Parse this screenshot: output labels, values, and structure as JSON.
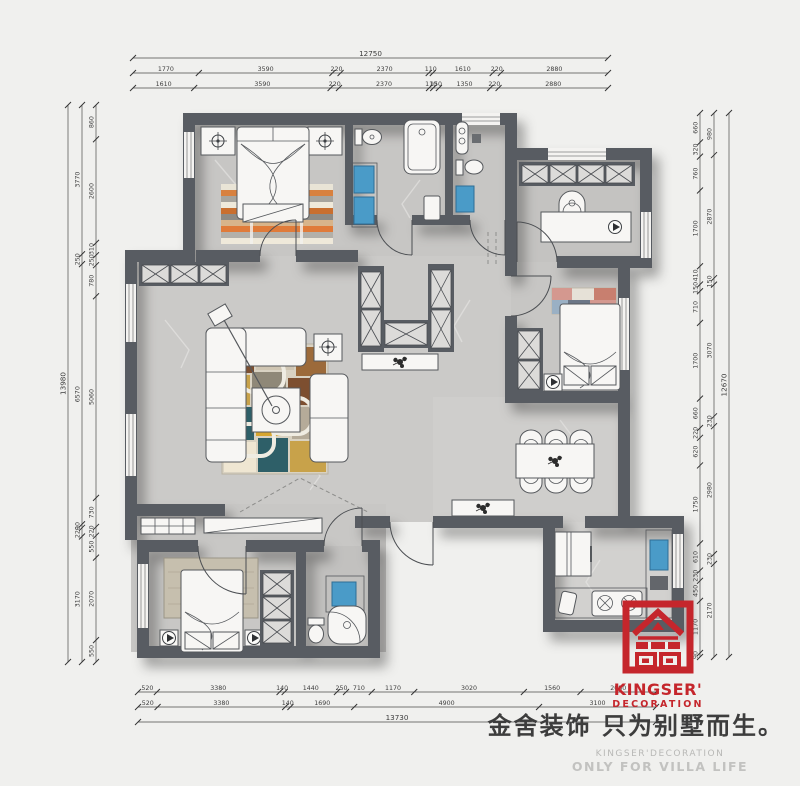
{
  "branding": {
    "logo_name": "KINGSER'",
    "logo_sub": "DECORATION",
    "slogan_cn": "金舍装饰 只为别墅而生。",
    "slogan_en_1": "KINGSER'DECORATION",
    "slogan_en_2": "ONLY FOR VILLA LIFE",
    "logo_color": "#c5262c"
  },
  "colors": {
    "background": "#f0f0ee",
    "wall": "#585c62",
    "floor": "#c9c8c6",
    "fixture_blue": "#4a9bc8",
    "accent_red": "#c5262c"
  },
  "dimensions": {
    "unit": "mm",
    "top_rows": [
      [
        "12750"
      ],
      [
        "1770",
        "3590",
        "220",
        "2370",
        "110",
        "1610",
        "220",
        "2880"
      ],
      [
        "1610",
        "3590",
        "220",
        "2370",
        "110",
        "150",
        "1350",
        "220",
        "2880"
      ]
    ],
    "bottom_rows": [
      [
        "520",
        "3380",
        "140",
        "1440",
        "250",
        "710",
        "1170",
        "3020",
        "1560",
        "2080"
      ],
      [
        "520",
        "3380",
        "140",
        "1690",
        "4900",
        "3100"
      ],
      [
        "13730"
      ]
    ],
    "left_cols": [
      [
        "13980"
      ],
      [
        "3770",
        "250",
        "6570",
        "90",
        "220",
        "3170"
      ],
      [
        "860",
        "2600",
        "310",
        "250",
        "780",
        "5060",
        "730",
        "220",
        "550",
        "2070",
        "550"
      ]
    ],
    "right_cols": [
      [
        "660",
        "320",
        "760",
        "1700",
        "410",
        "150",
        "710",
        "1700",
        "660",
        "220",
        "620",
        "1750",
        "610",
        "230",
        "450",
        "1170",
        "90"
      ],
      [
        "980",
        "2870",
        "150",
        "3070",
        "230",
        "2980",
        "230",
        "2170"
      ],
      [
        "12670"
      ]
    ]
  }
}
